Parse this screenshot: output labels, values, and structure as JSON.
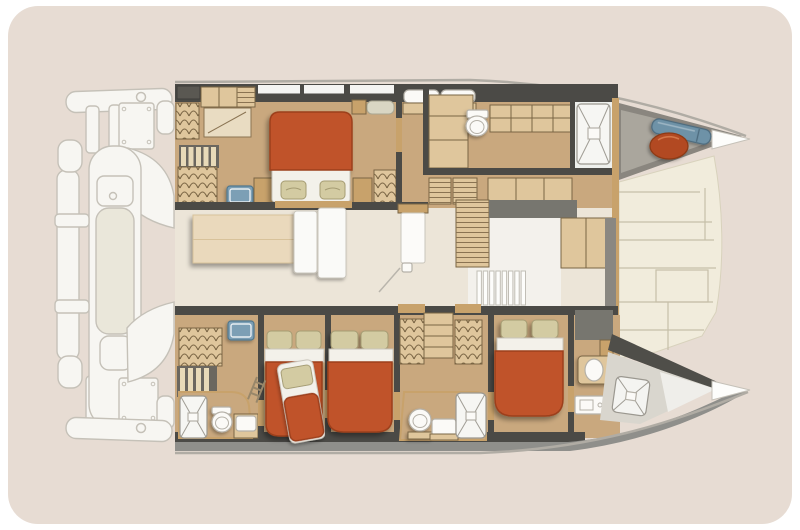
{
  "colors": {
    "page_bg": "#ffffff",
    "card_bg": "#e7dcd3",
    "hull_floor": "#c9a87e",
    "salon_floor": "#ece5d8",
    "deck_floor": "#f1ecdc",
    "deck_line": "#c6bfa8",
    "wall": "#4b4a46",
    "side_deck": "#8f8f8b",
    "coachroof_gray": "#77766f",
    "locker_gray": "#8a867f",
    "locker_gray_light": "#aaa69d",
    "wood": "#dfc69c",
    "wood_dark": "#c8a26b",
    "wood_stroke": "#7a6544",
    "wood_light": "#ead9bc",
    "bed_orange": "#c0522a",
    "bed_orange_dark": "#9c3f1b",
    "mattress_white": "#f3f1ea",
    "pillow": "#d3cba2",
    "pillow_stroke": "#a59c73",
    "fixture_white": "#fbfaf7",
    "fixture_stroke": "#b5b1a8",
    "sink_blue": "#7b9fb5",
    "sink_blue_dark": "#51778d",
    "fender_orange": "#b24a20",
    "sailbag_blue": "#6e92a7",
    "sailbag_blue_dark": "#4e6b7d",
    "stern_white": "#f7f6f2",
    "stern_stroke": "#c5c1b8",
    "stern_inner": "#eae7da",
    "window_white": "#f4f4f2"
  },
  "plan": {
    "type": "catamaran-yacht-floor-plan",
    "label": "Catamaran floor plan",
    "port_hull_label": "Upper hull: wardrobe, desk, stairs, double bed, vanity, toilet, galley counters, shower",
    "starboard_hull_label": "Lower hull: shower, toilet, sink, wardrobes, stairs, three double beds, two bathrooms",
    "salon_label": "Salon: dining table, sofa, door, companionway steps, cabinets",
    "foredeck_label": "Foredeck panels with bow locker, fender and sail bag",
    "stern_label": "Aft platforms, crossbeams and transom steps"
  }
}
